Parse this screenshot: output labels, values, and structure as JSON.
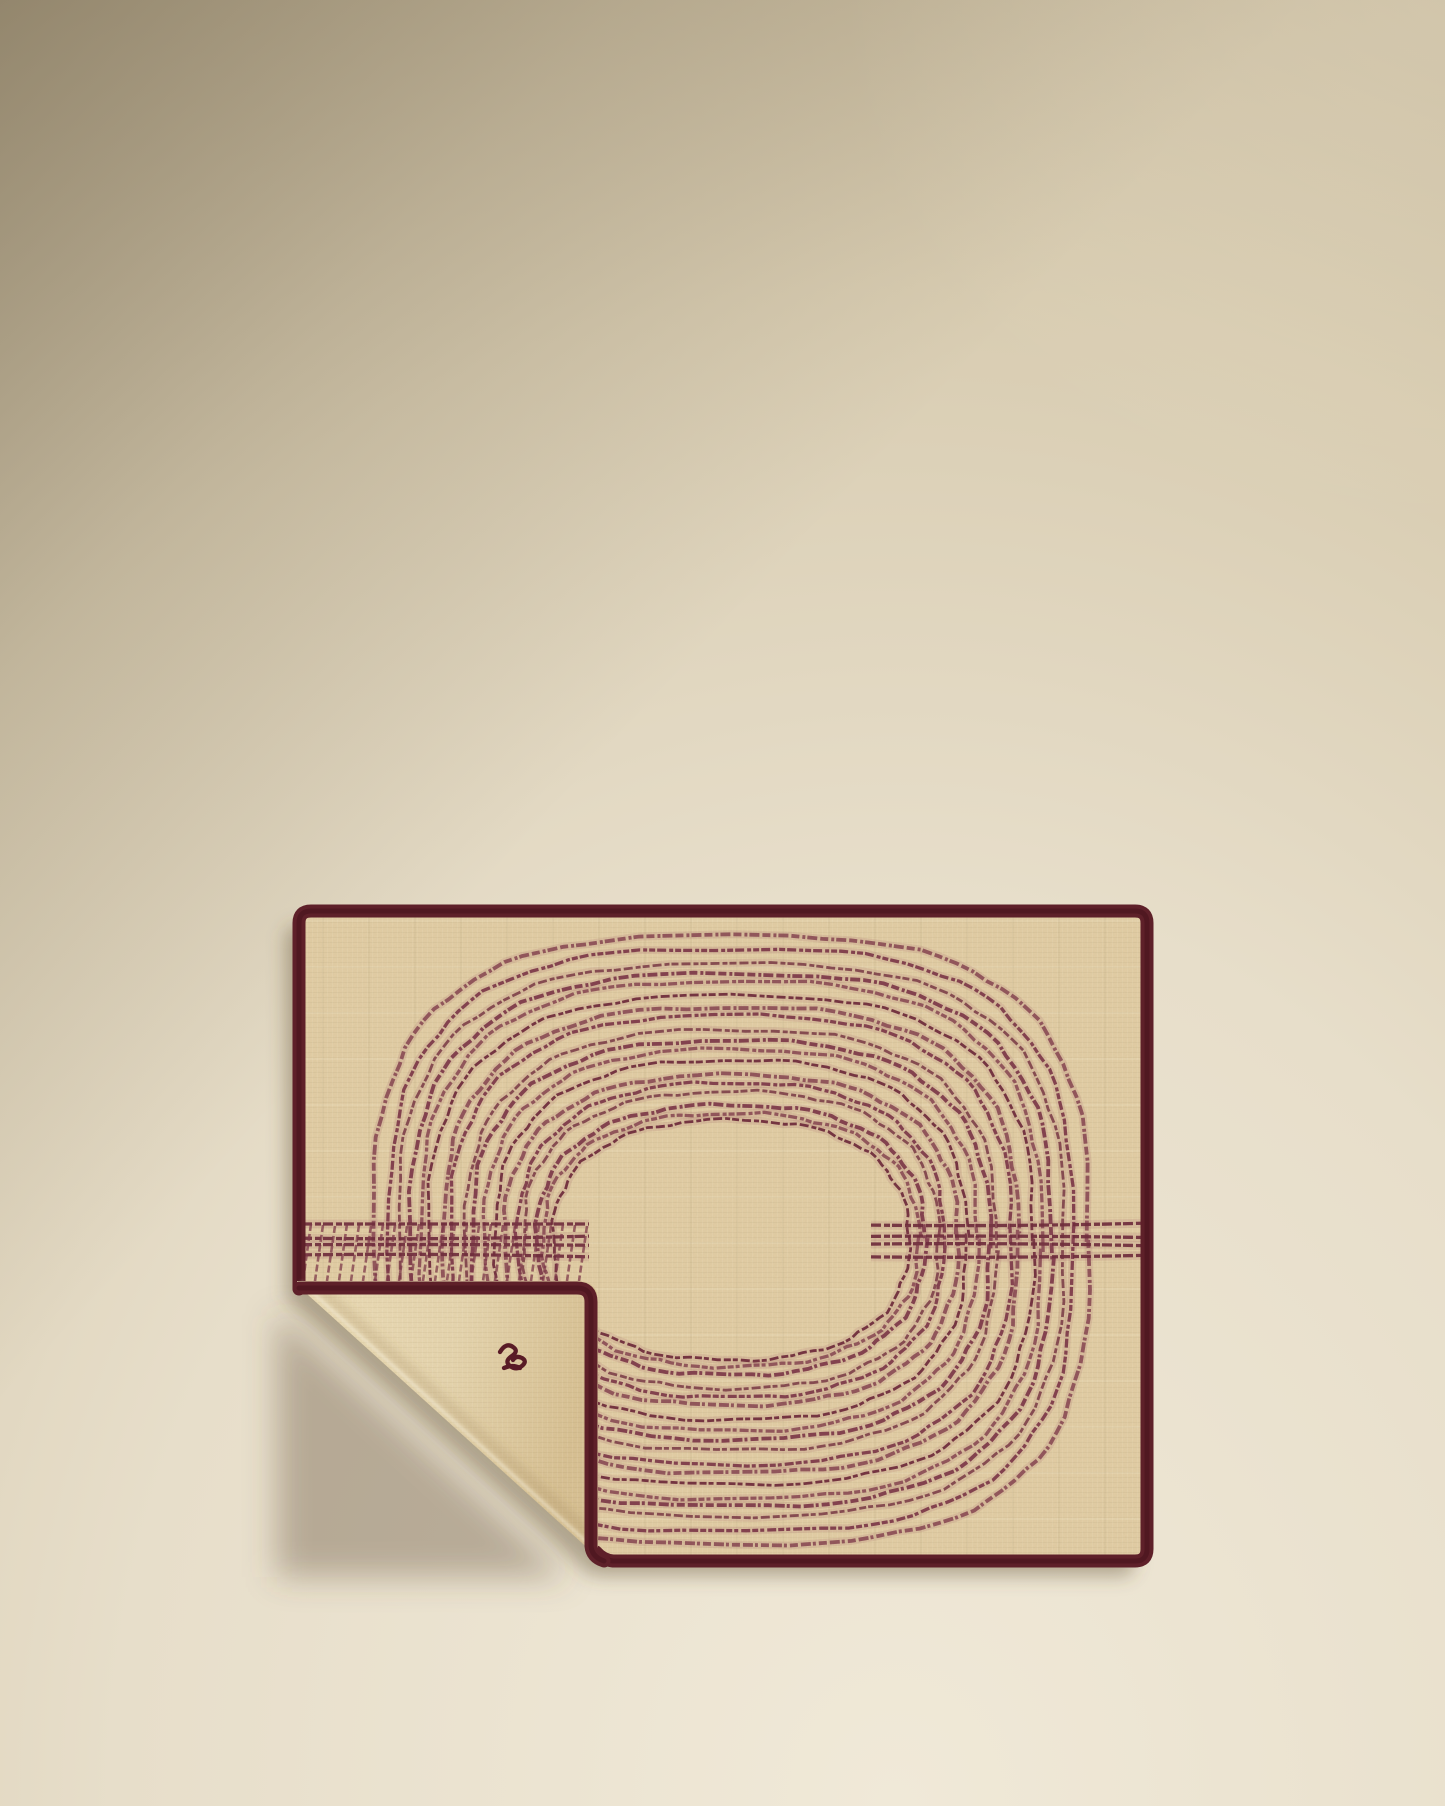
{
  "scene": {
    "description": "Product photo: beige linen placemat with burgundy embroidered concentric oval stitching, dark burgundy trimmed edges, bottom-left corner folded over revealing plain underside with a small embroidered monogram, on a warm cream backdrop shaded darker toward the top left.",
    "background": {
      "top_left": "#9d8f73",
      "top_right": "#cfc0a6",
      "mid": "#d8ccb1",
      "bottom_left": "#f0e9d8",
      "bottom_right": "#e9e0d0"
    },
    "shadow_color": "rgba(92,76,50,0.42)",
    "fold_shadow_color": "rgba(92,76,50,0.36)"
  },
  "placemat": {
    "fabric_color": "#e2cda4",
    "fabric_color_light": "#ecdcb6",
    "fabric_color_fold_dark": "#d8c193",
    "trim_color": "#5e2029",
    "trim_color_dark": "#4a151e",
    "stitch_color": "#7d3a49",
    "stitch_color_dark": "#6f2d3c",
    "stitch_halo": "rgba(158,88,98,0.14)",
    "monogram": {
      "label": "embroidered script monogram",
      "color": "#591b26"
    },
    "embroidery": {
      "type": "concentric-ovals",
      "center": {
        "x": 731,
        "y": 1240
      },
      "inner": {
        "rx": 178,
        "ry": 118
      },
      "outer": {
        "rx": 356,
        "ry": 303
      },
      "squareness_inner": 2.4,
      "squareness_outer": 3.0,
      "ring_positions": [
        0,
        0.05,
        0.1,
        0.155,
        0.21,
        0.265,
        0.33,
        0.385,
        0.45,
        0.5,
        0.565,
        0.625,
        0.69,
        0.75,
        0.8,
        0.865,
        0.93,
        1
      ],
      "dash_patterns": [
        "9 3 5 2 7 3",
        "6 2 9 3 4 2",
        "8 3 3 2 10 3"
      ],
      "band": {
        "y": 1238,
        "segments": [
          [
            302,
            589
          ],
          [
            871,
            1145
          ]
        ],
        "line_offsets": [
          -14,
          -1,
          7,
          18
        ]
      },
      "hatch": {
        "x_start": 306,
        "x_end": 584,
        "step": 12,
        "y_top": 1224,
        "y_bottom": 1281
      }
    }
  }
}
